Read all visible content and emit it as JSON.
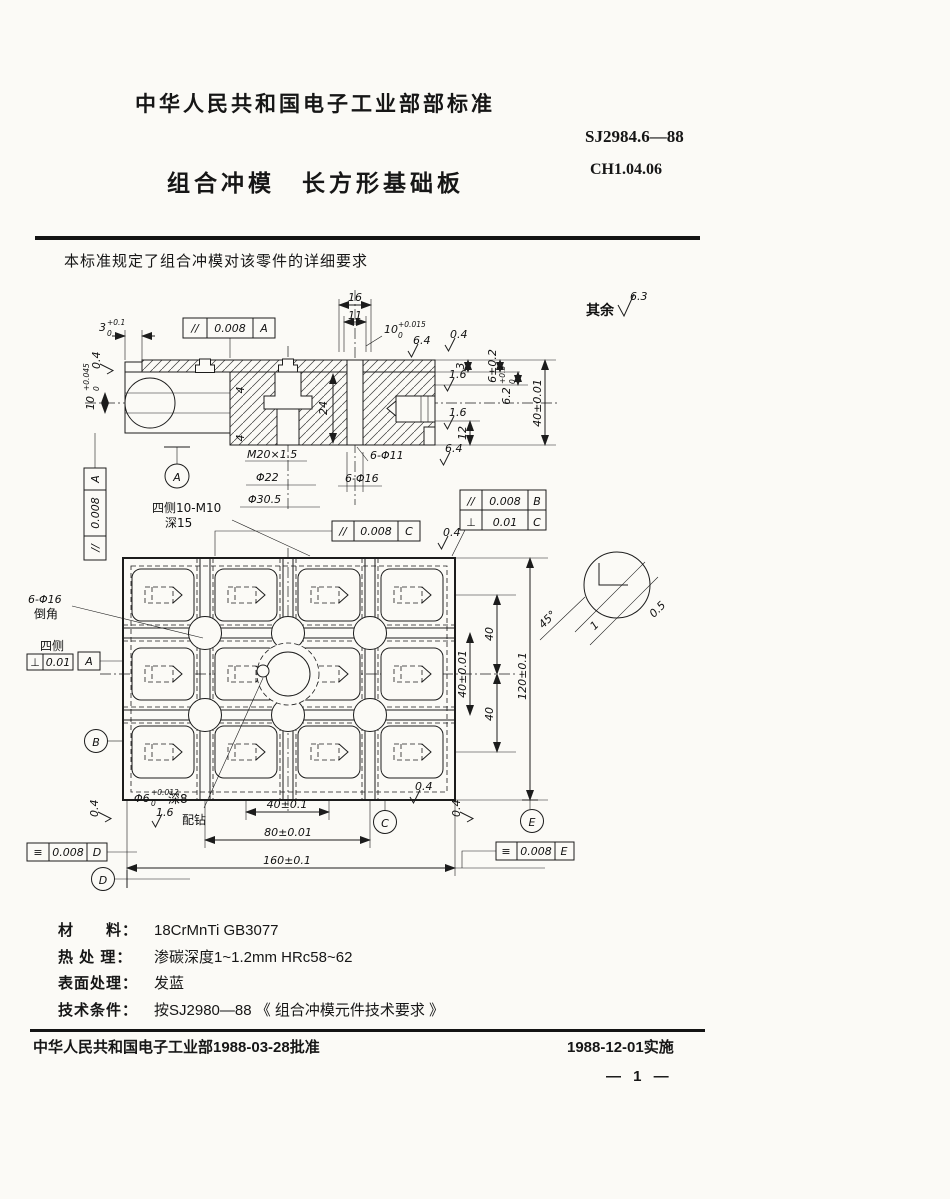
{
  "doc": {
    "standard_header": "中华人民共和国电子工业部部标准",
    "standard_number": "SJ2984.6—88",
    "code": "CH1.04.06",
    "title": "组合冲模　长方形基础板",
    "scope_note": "本标准规定了组合冲模对该零件的详细要求"
  },
  "specs": {
    "rows": [
      {
        "label": "材　　料：",
        "value": "18CrMnTi GB3077"
      },
      {
        "label": "热 处 理：",
        "value": "渗碳深度1~1.2mm HRc58~62"
      },
      {
        "label": "表面处理：",
        "value": "发蓝"
      },
      {
        "label": "技术条件：",
        "value": "按SJ2980—88 《 组合冲模元件技术要求 》"
      }
    ]
  },
  "footer": {
    "approved": "中华人民共和国电子工业部1988-03-28批准",
    "effective": "1988-12-01实施",
    "page": "— 1 —"
  },
  "drawing": {
    "surface_default": {
      "prefix": "其余",
      "value": "6.3"
    },
    "roughness": {
      "r04": "0.4",
      "r16": "1.6",
      "r64": "6.4"
    },
    "datums": {
      "a": "A",
      "b": "B",
      "c": "C",
      "d": "D",
      "e": "E"
    },
    "frames": {
      "top_a": {
        "sym": "//",
        "val": "0.008",
        "ref": "A"
      },
      "left_a": {
        "sym": "//",
        "val": "0.008",
        "ref": "A"
      },
      "c": {
        "sym": "//",
        "val": "0.008",
        "ref": "C"
      },
      "b": {
        "sym": "//",
        "val": "0.008",
        "ref": "B"
      },
      "c2": {
        "sym": "⊥",
        "val": "0.01",
        "ref": "C"
      },
      "plan_a": {
        "sym": "⊥",
        "val": "0.01",
        "ref": "A",
        "note": "四侧"
      },
      "d": {
        "sym": "≡",
        "val": "0.008",
        "ref": "D"
      },
      "e": {
        "sym": "≡",
        "val": "0.008",
        "ref": "E"
      }
    },
    "section_dims": {
      "d16": "16",
      "d11": "11",
      "d10": {
        "v": "10",
        "sup": "+0.015",
        "sub": "0"
      },
      "d3tl": {
        "v": "3",
        "sup": "+0.1",
        "sub": "0"
      },
      "d10l": {
        "v": "10",
        "sup": "+0.045",
        "sub": "0"
      },
      "d3r": "3",
      "d6": "6±0.2",
      "d62": {
        "v": "6.2",
        "sup": "+0.3",
        "sub": "0"
      },
      "d12": "12",
      "d40": "40±0.01",
      "d24": "24",
      "d4": "4",
      "m20": "M20×1.5",
      "phi22": "Φ22",
      "phi305": "Φ30.5",
      "n11": "6-Φ11",
      "n16": "6-Φ16"
    },
    "plan_dims": {
      "d40v": "40±0.01",
      "d40a": "40",
      "d40b": "40",
      "d120": "120±0.1",
      "a45": "45°",
      "c1": "1",
      "c05": "0.5",
      "d40h": "40±0.1",
      "d80": "80±0.01",
      "d160": "160±0.1"
    },
    "notes": {
      "m10a": "四侧10-M10",
      "m10b": "深15",
      "c16a": "6-Φ16",
      "c16b": "倒角",
      "fit_d": "Φ6",
      "fit_sup": "+0.012",
      "fit_sub": "0",
      "fit_depth": "深8",
      "fit_note": "配钻"
    }
  }
}
